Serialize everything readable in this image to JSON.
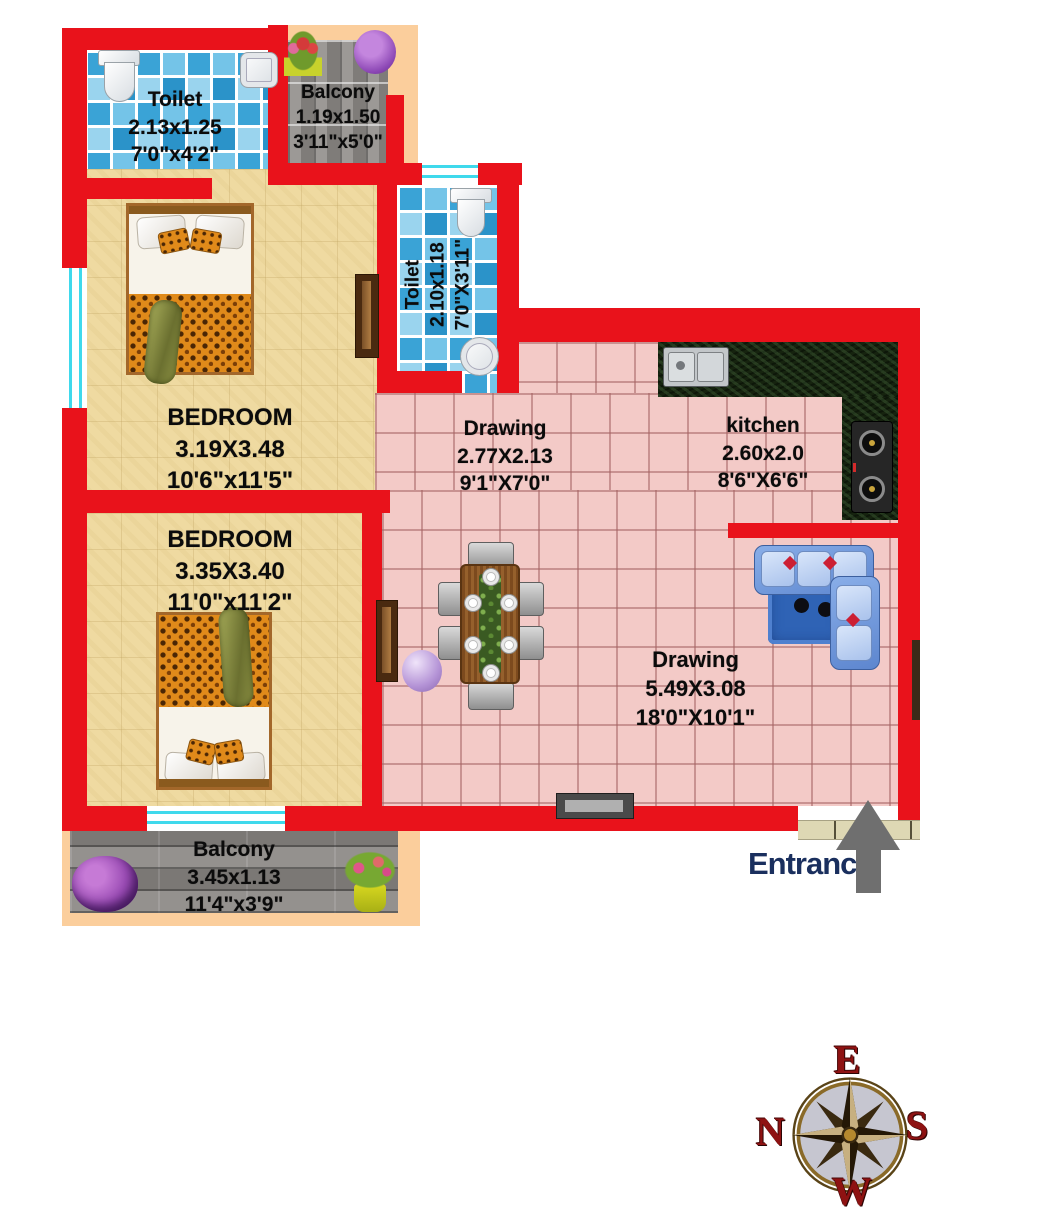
{
  "rooms": {
    "toilet1": {
      "name": "Toilet",
      "metric": "2.13x1.25",
      "imperial": "7'0\"x4'2\""
    },
    "balcony_top": {
      "name": "Balcony",
      "metric": "1.19x1.50",
      "imperial": "3'11\"x5'0\""
    },
    "bedroom1": {
      "name": "BEDROOM",
      "metric": "3.19X3.48",
      "imperial": "10'6\"x11'5\""
    },
    "toilet2": {
      "name": "Toilet",
      "metric": "2.10x1.18",
      "imperial": "7'0\"X3'11\""
    },
    "drawing_small": {
      "name": "Drawing",
      "metric": "2.77X2.13",
      "imperial": "9'1\"X7'0\""
    },
    "kitchen": {
      "name": "kitchen",
      "metric": "2.60x2.0",
      "imperial": "8'6\"X6'6\""
    },
    "bedroom2": {
      "name": "BEDROOM",
      "metric": "3.35X3.40",
      "imperial": "11'0\"x11'2\""
    },
    "drawing_large": {
      "name": "Drawing",
      "metric": "5.49X3.08",
      "imperial": "18'0\"X10'1\""
    },
    "balcony_bottom": {
      "name": "Balcony",
      "metric": "3.45x1.13",
      "imperial": "11'4\"x3'9\""
    }
  },
  "entrance": {
    "label": "Entrance"
  },
  "compass": {
    "top": "E",
    "right": "S",
    "bottom": "W",
    "left": "N"
  },
  "colors": {
    "wall": "#e9121b",
    "bedroom_floor": "#efdaa1",
    "drawing_floor": "#f3cac7",
    "toilet_tile": "#45a9dc",
    "balcony_paver": "#8e8b88",
    "kitchen_counter": "#16230f",
    "exterior": "#fbce9c",
    "entrance_text": "#1a2f5e",
    "arrow": "#6f6f6f",
    "compass_letter": "#8e1212"
  }
}
